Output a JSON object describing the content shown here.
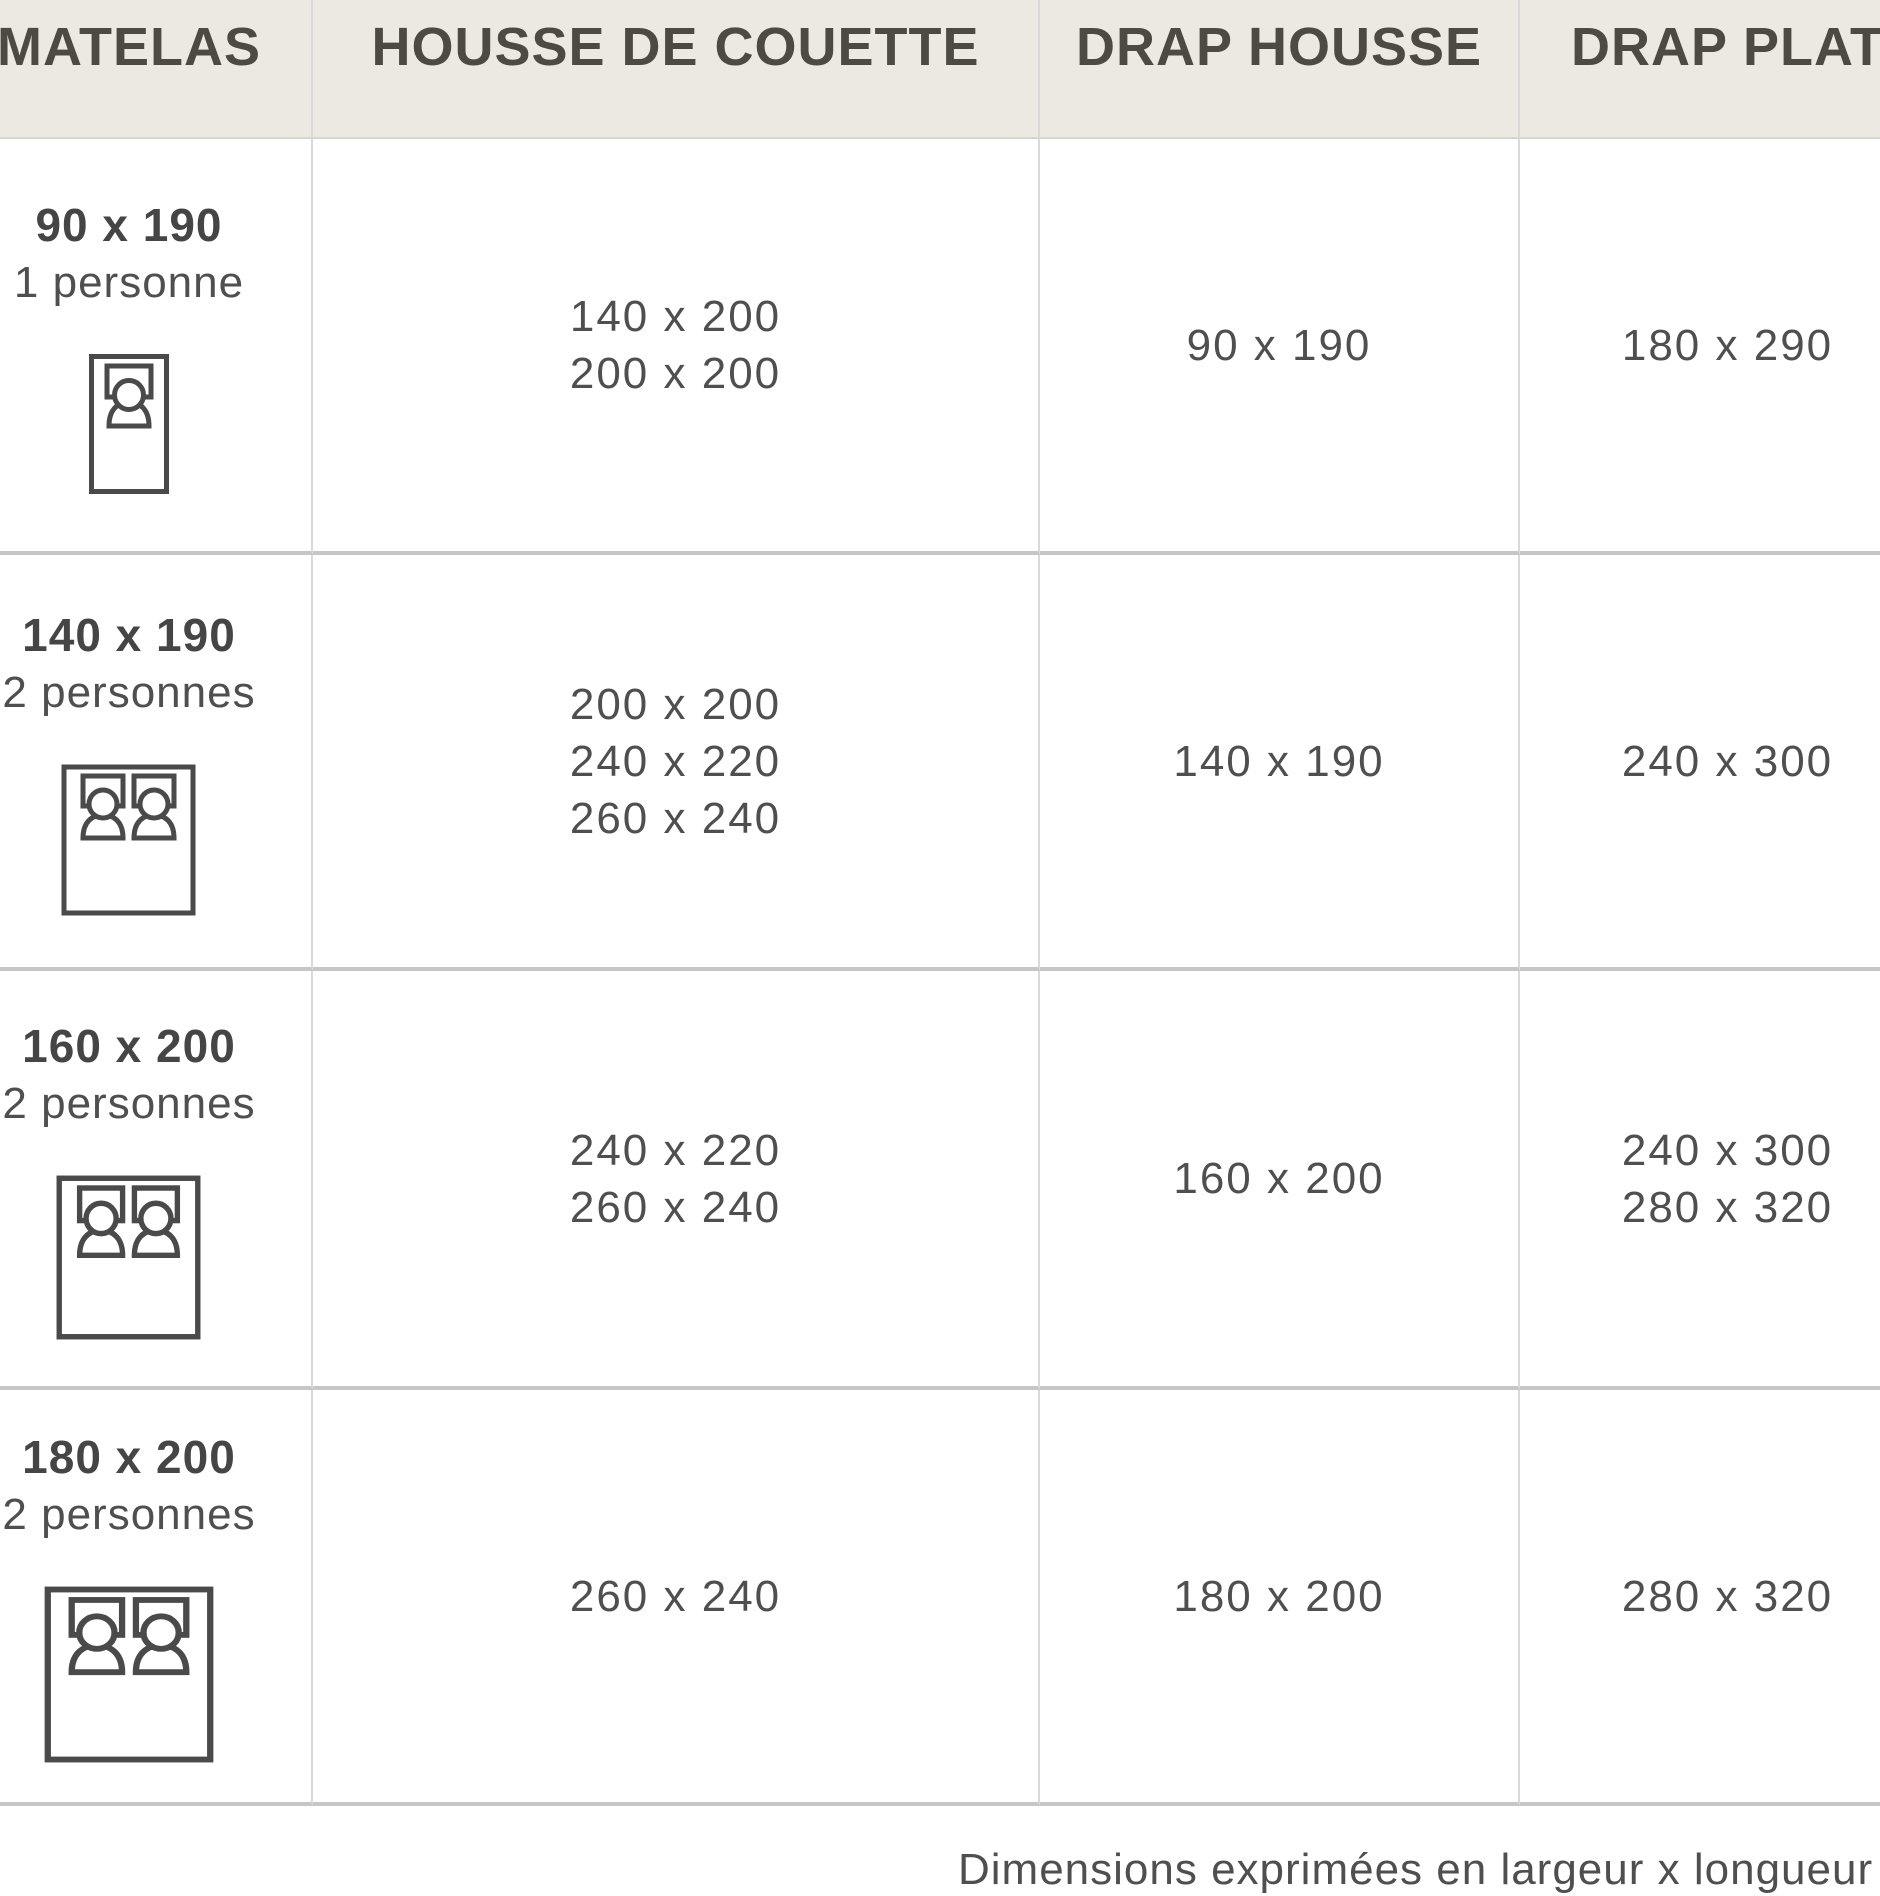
{
  "header": {
    "columns": [
      "MATELAS",
      "HOUSSE DE COUETTE",
      "DRAP HOUSSE",
      "DRAP PLAT"
    ]
  },
  "rows": [
    {
      "mattress_size": "90 x 190",
      "capacity": "1 personne",
      "bed_icon": "single-bed-one-person-icon",
      "housse_de_couette": [
        "140 x 200",
        "200 x 200"
      ],
      "drap_housse": [
        "90 x 190"
      ],
      "drap_plat": [
        "180 x 290"
      ]
    },
    {
      "mattress_size": "140 x 190",
      "capacity": "2 personnes",
      "bed_icon": "double-bed-two-persons-icon",
      "housse_de_couette": [
        "200 x 200",
        "240 x 220",
        "260 x 240"
      ],
      "drap_housse": [
        "140 x 190"
      ],
      "drap_plat": [
        "240 x 300"
      ]
    },
    {
      "mattress_size": "160 x 200",
      "capacity": "2 personnes",
      "bed_icon": "double-bed-two-persons-icon",
      "housse_de_couette": [
        "240 x 220",
        "260 x 240"
      ],
      "drap_housse": [
        "160 x 200"
      ],
      "drap_plat": [
        "240 x 300",
        "280 x 320"
      ]
    },
    {
      "mattress_size": "180 x 200",
      "capacity": "2 personnes",
      "bed_icon": "double-bed-two-persons-icon",
      "housse_de_couette": [
        "260 x 240"
      ],
      "drap_housse": [
        "180 x 200"
      ],
      "drap_plat": [
        "280 x 320"
      ]
    }
  ],
  "footer": {
    "note": "Dimensions exprimées en largeur x longueur (cm"
  },
  "colors": {
    "header_bg": "#ECE9E2",
    "header_text": "#4D4A44",
    "body_text": "#4F4F4F",
    "row_border": "#C6C6C6",
    "column_border": "#D9D9D7",
    "icon_stroke": "#4A4A4A"
  }
}
